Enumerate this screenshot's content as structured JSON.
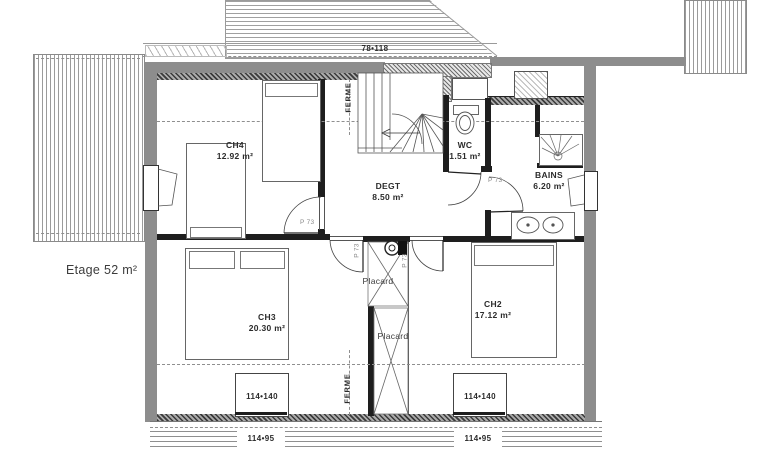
{
  "title": "Etage 52 m²",
  "rooms": {
    "ch4": {
      "name": "CH4",
      "area": "12.92 m²"
    },
    "wc": {
      "name": "WC",
      "area": "1.51 m²"
    },
    "bains": {
      "name": "BAINS",
      "area": "6.20 m²"
    },
    "degt": {
      "name": "DEGT",
      "area": "8.50 m²"
    },
    "ch3": {
      "name": "CH3",
      "area": "20.30 m²"
    },
    "ch2": {
      "name": "CH2",
      "area": "17.12 m²"
    }
  },
  "labels": {
    "placard": "Placard",
    "ferme": "FERME",
    "door": "P 73"
  },
  "dimensions": {
    "roof_window": "78•118",
    "window_main": "114•140",
    "window_sub": "114•95"
  },
  "colors": {
    "wall_gray": "#8d8d8d",
    "wall_black": "#1e1e1e",
    "paper": "#ffffff"
  }
}
